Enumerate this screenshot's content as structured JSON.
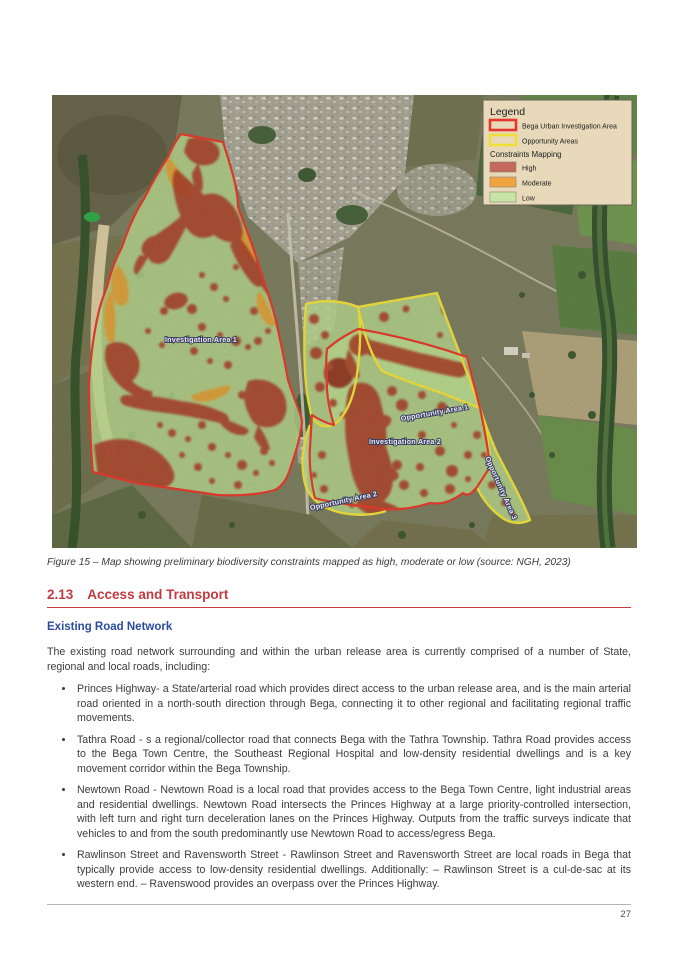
{
  "figure": {
    "caption": "Figure 15 – Map showing preliminary biodiversity constraints mapped as high, moderate or low (source: NGH, 2023)",
    "map": {
      "area_labels": {
        "ia1": "Investigation Area 1",
        "ia2": "Investigation Area 2",
        "opp1": "Opportunity Area 1",
        "opp2": "Opportunity Area 2",
        "opp3": "Opportunity Area 3"
      },
      "legend": {
        "title": "Legend",
        "items": [
          {
            "label": "Bega Urban Investigation Area",
            "outline_color": "#e5372b"
          },
          {
            "label": "Opportunity Areas",
            "outline_color": "#f0df3a"
          }
        ],
        "subtitle": "Constraints Mapping",
        "constraints": [
          {
            "label": "High",
            "color": "#c4685c"
          },
          {
            "label": "Moderate",
            "color": "#efa440"
          },
          {
            "label": "Low",
            "color": "#c9e5a5"
          }
        ]
      }
    }
  },
  "section": {
    "number": "2.13",
    "title": "Access and Transport",
    "subheading": "Existing Road Network",
    "intro": "The existing road network surrounding and within the urban release area is currently comprised of a number of State, regional and local roads, including:",
    "bullets": [
      "Princes Highway- a State/arterial road which provides direct access to the urban release area, and is the main arterial road oriented in a north-south direction through Bega, connecting it to other regional and facilitating regional traffic movements.",
      "Tathra Road - s a regional/collector road that connects Bega with the Tathra Township. Tathra Road provides access to the Bega Town Centre, the Southeast Regional Hospital and low-density residential dwellings and is a key movement corridor within the Bega Township.",
      "Newtown Road - Newtown Road is a local road that provides access to the Bega Town Centre, light industrial areas and residential dwellings. Newtown Road intersects the Princes Highway at a large priority-controlled intersection, with left turn and right turn deceleration lanes on the Princes Highway. Outputs from the traffic surveys indicate that vehicles to and from the south predominantly use Newtown Road to access/egress Bega.",
      "Rawlinson Street and Ravensworth Street - Rawlinson Street and Ravensworth Street are local roads in Bega that typically provide access to low-density residential dwellings. Additionally: – Rawlinson Street is a cul-de-sac at its western end. – Ravenswood provides an overpass over the Princes Highway."
    ]
  },
  "footer": {
    "page_number": "27"
  },
  "theme": {
    "heading_red": "#c23b41",
    "subheading_blue": "#2b4b9e",
    "low_green": "#b9d98e",
    "high_red": "#a83a28",
    "moderate_orange": "#e09a33"
  }
}
